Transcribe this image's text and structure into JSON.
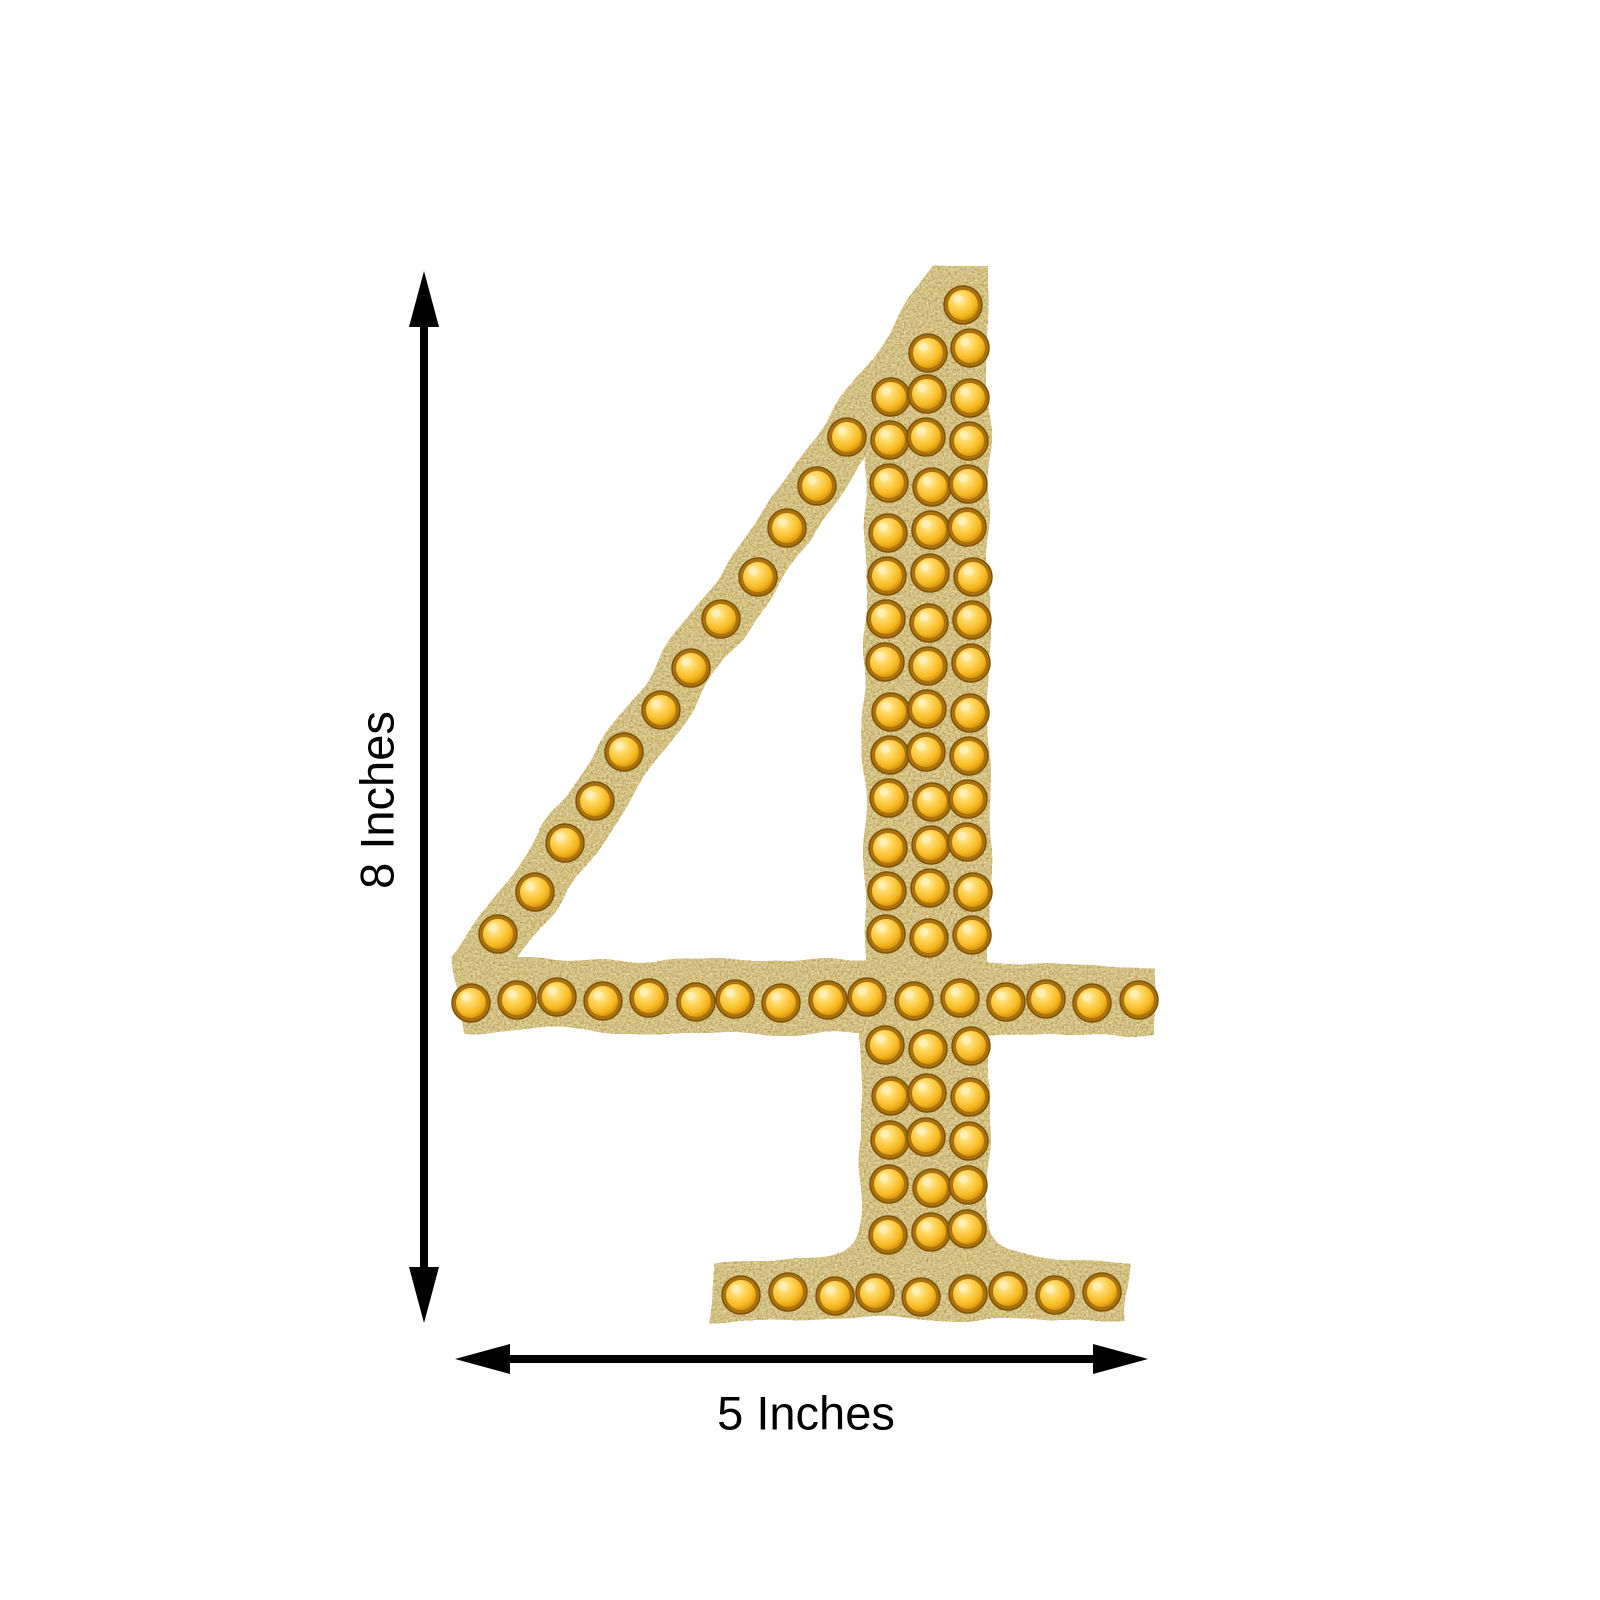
{
  "page": {
    "background": "#ffffff",
    "description": "Product dimension diagram: gold glitter rhinestone number 4 sticker, 8 inches tall by 5 inches wide"
  },
  "dimensions": {
    "height_label": "8 Inches",
    "width_label": "5 Inches"
  },
  "numeral": {
    "character": "4",
    "style": "gold glitter with round gold rhinestone studs",
    "stones": {
      "radius": 19,
      "positions": [
        [
          966,
          308
        ],
        [
          929,
          352
        ],
        [
          969,
          350
        ],
        [
          888,
          395
        ],
        [
          929,
          395
        ],
        [
          970,
          395
        ],
        [
          888,
          440
        ],
        [
          929,
          440
        ],
        [
          970,
          440
        ],
        [
          888,
          485
        ],
        [
          929,
          485
        ],
        [
          970,
          485
        ],
        [
          888,
          530
        ],
        [
          929,
          530
        ],
        [
          970,
          530
        ],
        [
          888,
          575
        ],
        [
          929,
          575
        ],
        [
          970,
          575
        ],
        [
          888,
          620
        ],
        [
          929,
          620
        ],
        [
          970,
          620
        ],
        [
          888,
          665
        ],
        [
          929,
          665
        ],
        [
          970,
          665
        ],
        [
          888,
          710
        ],
        [
          929,
          710
        ],
        [
          970,
          710
        ],
        [
          888,
          755
        ],
        [
          929,
          755
        ],
        [
          970,
          755
        ],
        [
          888,
          800
        ],
        [
          929,
          800
        ],
        [
          970,
          800
        ],
        [
          888,
          845
        ],
        [
          929,
          845
        ],
        [
          970,
          845
        ],
        [
          888,
          890
        ],
        [
          929,
          890
        ],
        [
          970,
          890
        ],
        [
          888,
          935
        ],
        [
          929,
          935
        ],
        [
          970,
          935
        ],
        [
          850,
          440
        ],
        [
          818,
          485
        ],
        [
          786,
          530
        ],
        [
          755,
          575
        ],
        [
          723,
          620
        ],
        [
          691,
          665
        ],
        [
          659,
          710
        ],
        [
          627,
          755
        ],
        [
          596,
          800
        ],
        [
          564,
          845
        ],
        [
          532,
          890
        ],
        [
          500,
          935
        ],
        [
          471,
          1000
        ],
        [
          515,
          1000
        ],
        [
          560,
          1000
        ],
        [
          604,
          1000
        ],
        [
          648,
          1000
        ],
        [
          693,
          1000
        ],
        [
          737,
          1000
        ],
        [
          781,
          1000
        ],
        [
          826,
          1000
        ],
        [
          870,
          1000
        ],
        [
          915,
          1000
        ],
        [
          959,
          1000
        ],
        [
          1003,
          1000
        ],
        [
          1048,
          1000
        ],
        [
          1092,
          1000
        ],
        [
          1137,
          1000
        ],
        [
          888,
          1048
        ],
        [
          929,
          1048
        ],
        [
          970,
          1048
        ],
        [
          888,
          1094
        ],
        [
          929,
          1094
        ],
        [
          970,
          1094
        ],
        [
          888,
          1140
        ],
        [
          929,
          1140
        ],
        [
          970,
          1140
        ],
        [
          888,
          1186
        ],
        [
          929,
          1186
        ],
        [
          970,
          1186
        ],
        [
          888,
          1232
        ],
        [
          929,
          1232
        ],
        [
          970,
          1232
        ],
        [
          742,
          1294
        ],
        [
          787,
          1294
        ],
        [
          832,
          1294
        ],
        [
          877,
          1294
        ],
        [
          921,
          1294
        ],
        [
          966,
          1294
        ],
        [
          1011,
          1294
        ],
        [
          1056,
          1294
        ],
        [
          1101,
          1294
        ]
      ]
    }
  },
  "colors": {
    "arrow": "#000000",
    "label_text": "#000000",
    "glitter_gold": "#b89a5a",
    "glitter_dark": "#4a3a15",
    "glitter_light": "#f3e8c2",
    "rhinestone": "#f6b81f",
    "rhinestone_mid": "#ffd65e",
    "rhinestone_rim": "#a9720e",
    "rhinestone_deep": "#bf7c08",
    "rhinestone_highlight": "#fff0b8"
  }
}
